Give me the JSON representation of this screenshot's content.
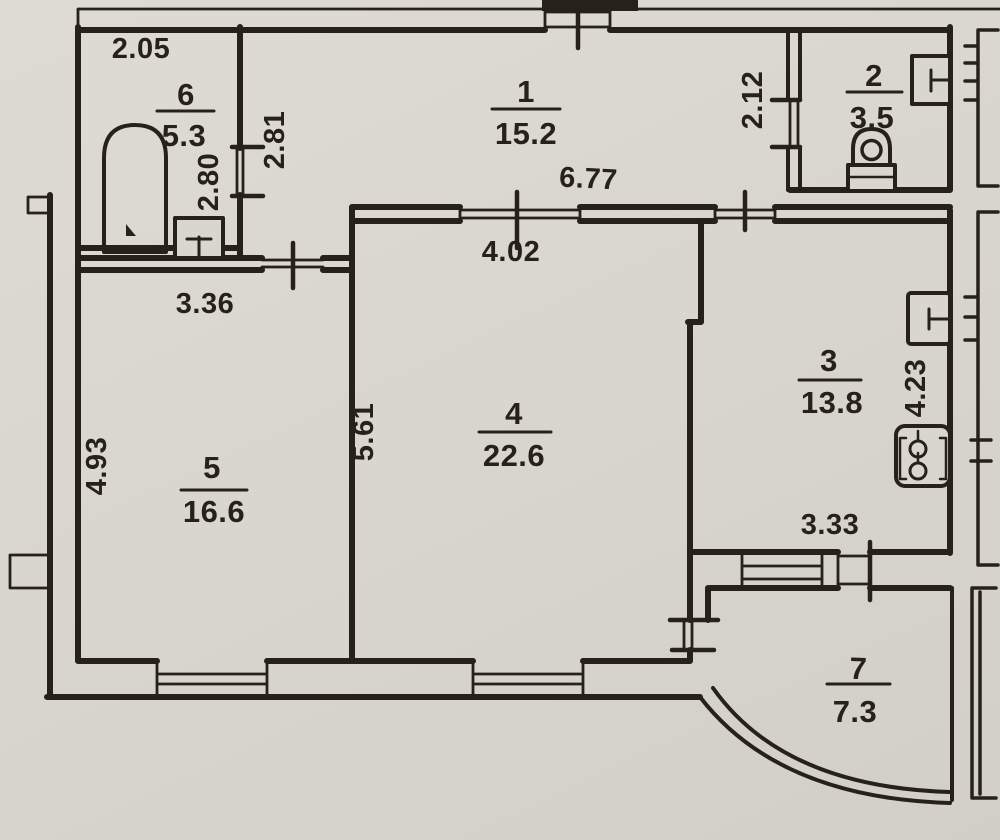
{
  "document": {
    "type": "apartment floor plan",
    "style": "scanned hand-drawn blueprint"
  },
  "colors": {
    "paper": "#d9d6cf",
    "ink": "#26221b"
  },
  "rooms": {
    "r1": {
      "number": "1",
      "area": "15.2"
    },
    "r2": {
      "number": "2",
      "area": "3.5"
    },
    "r3": {
      "number": "3",
      "area": "13.8"
    },
    "r4": {
      "number": "4",
      "area": "22.6"
    },
    "r5": {
      "number": "5",
      "area": "16.6"
    },
    "r6": {
      "number": "6",
      "area": "5.3"
    },
    "r7": {
      "number": "7",
      "area": "7.3"
    }
  },
  "dimensions": {
    "room6_width": "2.05",
    "room6_height": "2.80",
    "hall_left_height": "2.81",
    "hall_width": "6.77",
    "hall_right_height": "2.12",
    "room5_width": "3.36",
    "room5_height": "4.93",
    "room4_width": "4.02",
    "room4_height": "5.61",
    "room3_height": "4.23",
    "room3_width": "3.33"
  }
}
